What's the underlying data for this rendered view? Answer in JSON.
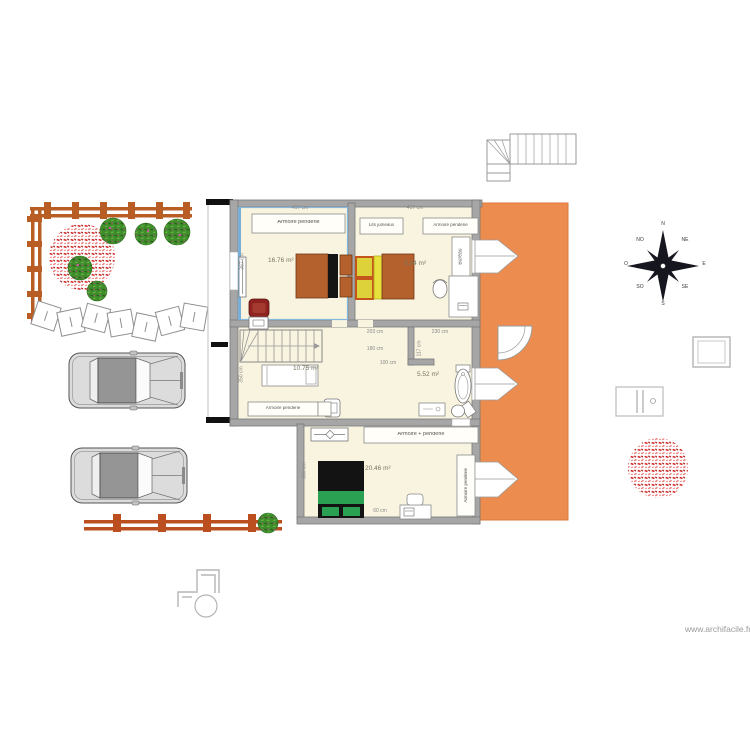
{
  "page": {
    "watermark": "www.archifacile.fr"
  },
  "compass": {
    "n": "N",
    "ne": "NE",
    "e": "E",
    "se": "SE",
    "s": "S",
    "sw": "SO",
    "w": "O",
    "nw": "NO"
  },
  "rooms": {
    "bedroom1_area": "16.76 m²",
    "bedroom2_area": "9.34 m²",
    "bedroom3_area": "10.75 m²",
    "bathroom_area": "5.52 m²",
    "bedroom4_area": "20.46 m²"
  },
  "furniture": {
    "wardrobe1": "Armoire penderie",
    "twin_beds": "Lits jumeaux",
    "wardrobe2": "Armoire penderie",
    "desk": "Bureau",
    "wardrobe3": "Armoire penderie",
    "wardrobe4": "Armoire + penderie",
    "wardrobe5": "Armoire penderie"
  },
  "dimensions": {
    "top_left_width": "457 cm",
    "top_right_width": "417 cm",
    "left_height": "367 cm",
    "hall_width": "203 cm",
    "bath_width": "230 cm",
    "hall_inner": "180 cm",
    "hall_lower": "100 cm",
    "bath_height": "117 cm",
    "desk_width": "60 cm",
    "mid_left_height": "350 cm",
    "bottom_left_height": "330 cm"
  },
  "colors": {
    "terrace": "#ec8c4e",
    "walls": "#a6a6a6",
    "floor": "#f8f4e0",
    "fence": "#bb5d22",
    "selection": "#79aed6",
    "bed_brown": "#b4612d",
    "bed_yellow": "#e7e13c",
    "bed_green": "#2aa053",
    "bed_black": "#131313",
    "armchair": "#8e2320"
  }
}
